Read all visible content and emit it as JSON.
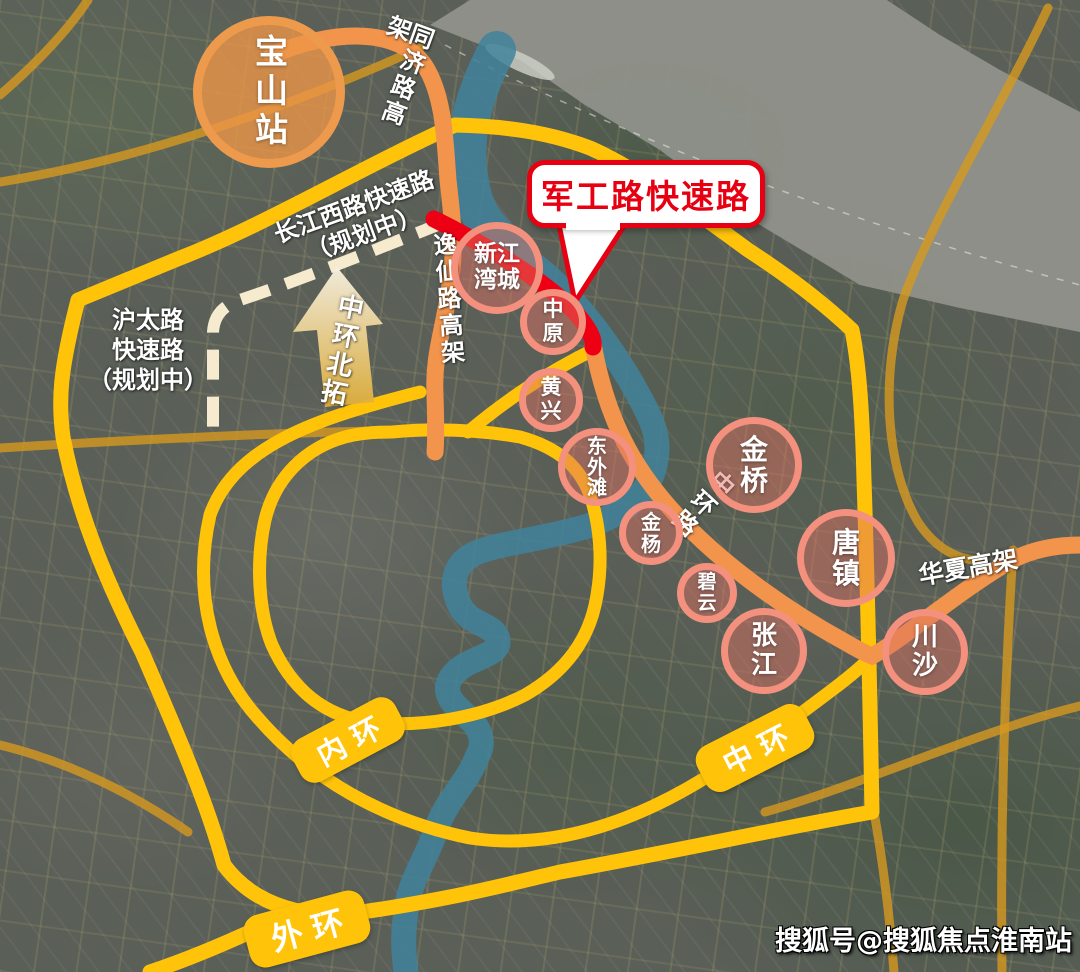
{
  "colors": {
    "ring_yellow": "#FFC40A",
    "elevated_orange": "#F2944B",
    "highlight_red": "#ED0013",
    "planned_cream": "#F6EBCF",
    "district_pink": "#F3907E",
    "station_orange": "#EE9A4D",
    "callout_red": "#E60012",
    "river_teal": "#41839B",
    "water_gray": "#8E9189"
  },
  "station": {
    "label": "宝山站"
  },
  "callout": {
    "label": "军工路快速路"
  },
  "roads": {
    "tongji": {
      "label": "同济路高架"
    },
    "yixian": {
      "label": "逸仙路高架"
    },
    "zhonghuan_road": {
      "label": "中环路"
    },
    "huaxia": {
      "label": "华夏高架"
    },
    "changjiang_west": {
      "label": "长江西路快速路\n（规划中）"
    },
    "hutai": {
      "label": "沪太路\n快速路\n（规划中）"
    },
    "zhonghuan_beituo": {
      "label": "中环北拓"
    }
  },
  "rings": {
    "inner": {
      "label": "内环"
    },
    "middle": {
      "label": "中环"
    },
    "outer": {
      "label": "外环"
    }
  },
  "districts": {
    "xinjiangwancheng": {
      "label": "新江\n湾城"
    },
    "zhongyuan": {
      "label": "中\n原"
    },
    "huangxing": {
      "label": "黄\n兴"
    },
    "dongwaitan": {
      "label": "东\n外\n滩"
    },
    "jinyang": {
      "label": "金\n杨"
    },
    "biyun": {
      "label": "碧\n云"
    },
    "jinqiao": {
      "label": "金\n桥"
    },
    "tangzhen": {
      "label": "唐\n镇"
    },
    "zhangjiang": {
      "label": "张\n江"
    },
    "chuansha": {
      "label": "川\n沙"
    }
  },
  "watermark": "搜狐号@搜狐焦点淮南站"
}
